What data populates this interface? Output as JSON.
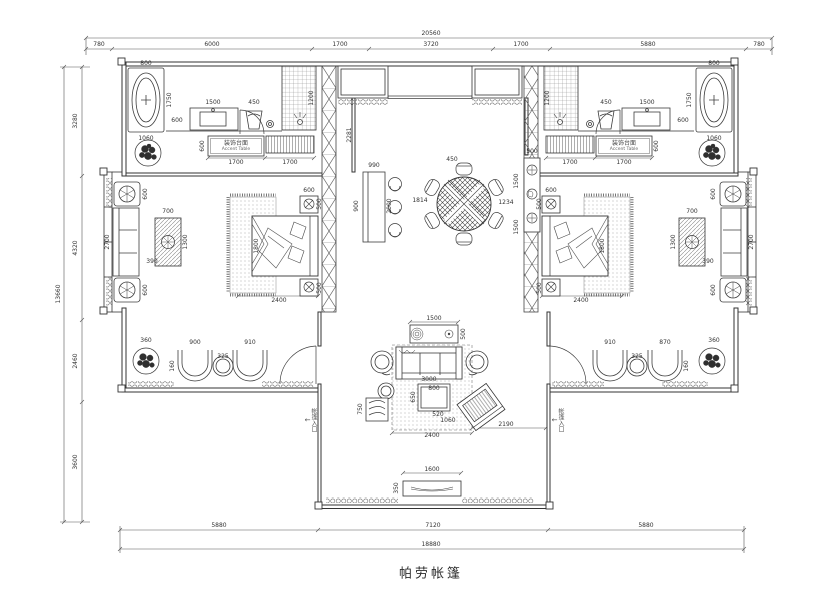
{
  "title": {
    "text": "帕劳帐篷"
  },
  "labels": {
    "accent_cn": "装饰台面",
    "accent_en": "Accent Table",
    "entry": "帐篷入口",
    "entry_arrow": "↓"
  },
  "colors": {
    "line": "#3d3d3d",
    "dim": "#555555",
    "hatch": "#888888",
    "bg": "#ffffff"
  },
  "annotations": [
    {
      "t": "20560",
      "x": 431,
      "y": 34
    },
    {
      "t": "780",
      "x": 99,
      "y": 45
    },
    {
      "t": "6000",
      "x": 212,
      "y": 45
    },
    {
      "t": "1700",
      "x": 340,
      "y": 45
    },
    {
      "t": "3720",
      "x": 431,
      "y": 45
    },
    {
      "t": "1700",
      "x": 521,
      "y": 45
    },
    {
      "t": "5880",
      "x": 648,
      "y": 45
    },
    {
      "t": "780",
      "x": 759,
      "y": 45
    },
    {
      "t": "13660",
      "x": 59,
      "y": 294,
      "r": 1
    },
    {
      "t": "3280",
      "x": 76,
      "y": 121,
      "r": 1
    },
    {
      "t": "4320",
      "x": 76,
      "y": 248,
      "r": 1
    },
    {
      "t": "2460",
      "x": 76,
      "y": 361,
      "r": 1
    },
    {
      "t": "3600",
      "x": 76,
      "y": 462,
      "r": 1
    },
    {
      "t": "5880",
      "x": 219,
      "y": 526
    },
    {
      "t": "7120",
      "x": 433,
      "y": 526
    },
    {
      "t": "5880",
      "x": 646,
      "y": 526
    },
    {
      "t": "18880",
      "x": 431,
      "y": 545
    },
    {
      "t": "800",
      "x": 146,
      "y": 64
    },
    {
      "t": "1750",
      "x": 170,
      "y": 100,
      "r": 1
    },
    {
      "t": "1060",
      "x": 146,
      "y": 139
    },
    {
      "t": "600",
      "x": 177,
      "y": 121
    },
    {
      "t": "1500",
      "x": 213,
      "y": 103
    },
    {
      "t": "450",
      "x": 254,
      "y": 103
    },
    {
      "t": "1200",
      "x": 312,
      "y": 98,
      "r": 1
    },
    {
      "t": "600",
      "x": 203,
      "y": 146,
      "r": 1
    },
    {
      "t": "1700",
      "x": 236,
      "y": 163
    },
    {
      "t": "1700",
      "x": 290,
      "y": 163
    },
    {
      "t": "800",
      "x": 714,
      "y": 64
    },
    {
      "t": "1750",
      "x": 690,
      "y": 100,
      "r": 1
    },
    {
      "t": "1060",
      "x": 714,
      "y": 139
    },
    {
      "t": "600",
      "x": 683,
      "y": 121
    },
    {
      "t": "1500",
      "x": 647,
      "y": 103
    },
    {
      "t": "450",
      "x": 606,
      "y": 103
    },
    {
      "t": "1200",
      "x": 548,
      "y": 98,
      "r": 1
    },
    {
      "t": "600",
      "x": 657,
      "y": 146,
      "r": 1
    },
    {
      "t": "1700",
      "x": 624,
      "y": 163
    },
    {
      "t": "1700",
      "x": 570,
      "y": 163
    },
    {
      "t": "600",
      "x": 309,
      "y": 191
    },
    {
      "t": "500",
      "x": 320,
      "y": 204,
      "r": 1
    },
    {
      "t": "500",
      "x": 320,
      "y": 288,
      "r": 1
    },
    {
      "t": "1800",
      "x": 257,
      "y": 246,
      "r": 1
    },
    {
      "t": "2400",
      "x": 279,
      "y": 301
    },
    {
      "t": "600",
      "x": 551,
      "y": 191
    },
    {
      "t": "500",
      "x": 540,
      "y": 204,
      "r": 1
    },
    {
      "t": "500",
      "x": 540,
      "y": 288,
      "r": 1
    },
    {
      "t": "1800",
      "x": 603,
      "y": 246,
      "r": 1
    },
    {
      "t": "2400",
      "x": 581,
      "y": 301
    },
    {
      "t": "600",
      "x": 146,
      "y": 194,
      "r": 1
    },
    {
      "t": "2700",
      "x": 108,
      "y": 242,
      "r": 1
    },
    {
      "t": "600",
      "x": 146,
      "y": 290,
      "r": 1
    },
    {
      "t": "700",
      "x": 168,
      "y": 212
    },
    {
      "t": "1300",
      "x": 186,
      "y": 242,
      "r": 1
    },
    {
      "t": "390",
      "x": 152,
      "y": 262
    },
    {
      "t": "600",
      "x": 714,
      "y": 194,
      "r": 1
    },
    {
      "t": "2700",
      "x": 752,
      "y": 242,
      "r": 1
    },
    {
      "t": "600",
      "x": 714,
      "y": 290,
      "r": 1
    },
    {
      "t": "700",
      "x": 692,
      "y": 212
    },
    {
      "t": "1300",
      "x": 674,
      "y": 242,
      "r": 1
    },
    {
      "t": "390",
      "x": 708,
      "y": 262
    },
    {
      "t": "360",
      "x": 146,
      "y": 341
    },
    {
      "t": "900",
      "x": 195,
      "y": 343
    },
    {
      "t": "325",
      "x": 223,
      "y": 357
    },
    {
      "t": "910",
      "x": 250,
      "y": 343
    },
    {
      "t": "160",
      "x": 173,
      "y": 366,
      "r": 1
    },
    {
      "t": "360",
      "x": 714,
      "y": 341
    },
    {
      "t": "910",
      "x": 610,
      "y": 343
    },
    {
      "t": "325",
      "x": 637,
      "y": 357
    },
    {
      "t": "870",
      "x": 665,
      "y": 343
    },
    {
      "t": "160",
      "x": 687,
      "y": 366,
      "r": 1
    },
    {
      "t": "2281",
      "x": 350,
      "y": 135,
      "r": 1
    },
    {
      "t": "990",
      "x": 374,
      "y": 166
    },
    {
      "t": "900",
      "x": 357,
      "y": 206,
      "r": 1
    },
    {
      "t": "2000",
      "x": 390,
      "y": 206,
      "r": 1
    },
    {
      "t": "1814",
      "x": 420,
      "y": 201
    },
    {
      "t": "450",
      "x": 452,
      "y": 160
    },
    {
      "t": "1234",
      "x": 506,
      "y": 203
    },
    {
      "t": "500",
      "x": 532,
      "y": 152
    },
    {
      "t": "1500",
      "x": 517,
      "y": 181,
      "r": 1
    },
    {
      "t": "1500",
      "x": 517,
      "y": 227,
      "r": 1
    },
    {
      "t": "1500",
      "x": 434,
      "y": 319
    },
    {
      "t": "500",
      "x": 464,
      "y": 334,
      "r": 1
    },
    {
      "t": "3000",
      "x": 429,
      "y": 380
    },
    {
      "t": "800",
      "x": 434,
      "y": 389
    },
    {
      "t": "650",
      "x": 414,
      "y": 397,
      "r": 1
    },
    {
      "t": "520",
      "x": 438,
      "y": 415
    },
    {
      "t": "1060",
      "x": 448,
      "y": 421
    },
    {
      "t": "750",
      "x": 361,
      "y": 409,
      "r": 1
    },
    {
      "t": "2400",
      "x": 432,
      "y": 436
    },
    {
      "t": "2190",
      "x": 506,
      "y": 425
    },
    {
      "t": "1600",
      "x": 432,
      "y": 470
    },
    {
      "t": "350",
      "x": 397,
      "y": 488,
      "r": 1
    }
  ]
}
